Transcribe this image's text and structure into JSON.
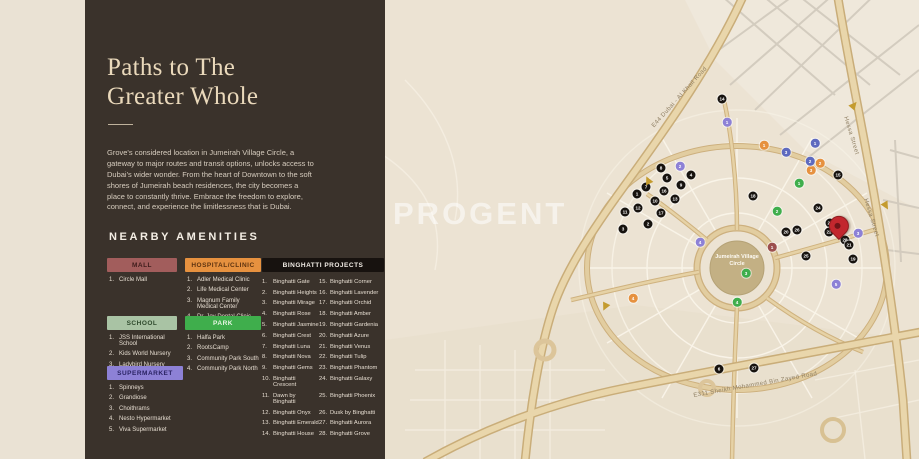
{
  "panel": {
    "title_line1": "Paths to The",
    "title_line2": "Greater Whole",
    "description": "Grove's considered location in Jumeirah Village Circle, a gateway to major routes and transit options, unlocks access to Dubai's wider wonder. From the heart of Downtown to the soft shores of Jumeirah beach residences, the city becomes a place to constantly thrive. Embrace the freedom to explore, connect, and experience the limitlessness that is Dubai.",
    "amenities_heading": "NEARBY AMENITIES",
    "categories": [
      {
        "id": "mall",
        "label": "MALL",
        "color": "#a25d5c",
        "text_color": "#3f1d1c",
        "items": [
          "Circle Mall"
        ]
      },
      {
        "id": "hospital",
        "label": "HOSPITAL/CLINIC",
        "color": "#e6913f",
        "text_color": "#5d3310",
        "items": [
          "Adler Medical Clinic",
          "Life Medical Center",
          "Magnum Family Medical Center",
          "Dr. Joy Dental Clinic"
        ]
      },
      {
        "id": "school",
        "label": "SCHOOL",
        "color": "#a9c3a4",
        "text_color": "#2f4a2d",
        "items": [
          "JSS International School",
          "Kids World Nursery",
          "Ladybird Nursery"
        ]
      },
      {
        "id": "park",
        "label": "PARK",
        "color": "#3fae4c",
        "text_color": "#e8f5e4",
        "items": [
          "Halfa Park",
          "RootsCamp",
          "Community Park South",
          "Community Park North"
        ]
      },
      {
        "id": "supermarket",
        "label": "SUPERMARKET",
        "color": "#8d81d6",
        "text_color": "#2a2363",
        "items": [
          "Spinneys",
          "Grandiose",
          "Choithrams",
          "Nesto Hypermarket",
          "Viva Supermarket"
        ]
      }
    ],
    "projects": {
      "label": "BINGHATTI PROJECTS",
      "color": "#17120f",
      "text_color": "#f2ede6",
      "items_left": [
        "Binghatti Gate",
        "Binghatti Heights",
        "Binghatti Mirage",
        "Binghatti Rose",
        "Binghatti Jasmine",
        "Binghatti Crest",
        "Binghatti Luna",
        "Binghatti Nova",
        "Binghatti Gems",
        "Binghatti Crescent",
        "Dawn by Binghatti",
        "Binghatti Onyx",
        "Binghatti Emerald",
        "Binghatti House"
      ],
      "items_right": [
        "Binghatti Corner",
        "Binghatti Lavender",
        "Binghatti Orchid",
        "Binghatti Amber",
        "Binghatti Gardenia",
        "Binghatti Azure",
        "Binghatti Venus",
        "Binghatti Tulip",
        "Binghatti Phantom",
        "Binghatti Galaxy",
        "Binghatti Phoenix",
        "Dusk by Binghatti",
        "Binghatti Aurora",
        "Binghatti Grove"
      ]
    }
  },
  "map": {
    "watermark": "PROGENT",
    "center_label": "Jumeirah Village Circle",
    "road_labels": [
      {
        "text": "E44 Dubai - Al Khail Road"
      },
      {
        "text": "Hessa Street"
      },
      {
        "text": "Hessa Street"
      },
      {
        "text": "E311 Sheikh Mohammed Bin Zayed Road"
      }
    ],
    "marker_colors": {
      "project": "#17130f"
    },
    "markers": {
      "projects": [
        {
          "n": 14,
          "x": 722,
          "y": 99
        },
        {
          "n": 8,
          "x": 661,
          "y": 168
        },
        {
          "n": 5,
          "x": 667,
          "y": 178
        },
        {
          "n": 4,
          "x": 691,
          "y": 175
        },
        {
          "n": 9,
          "x": 681,
          "y": 185
        },
        {
          "n": 7,
          "x": 646,
          "y": 187
        },
        {
          "n": 1,
          "x": 637,
          "y": 194
        },
        {
          "n": 16,
          "x": 664,
          "y": 191
        },
        {
          "n": 13,
          "x": 675,
          "y": 199
        },
        {
          "n": 10,
          "x": 655,
          "y": 201
        },
        {
          "n": 12,
          "x": 638,
          "y": 208
        },
        {
          "n": 17,
          "x": 661,
          "y": 213
        },
        {
          "n": 11,
          "x": 625,
          "y": 212
        },
        {
          "n": 2,
          "x": 648,
          "y": 224
        },
        {
          "n": 3,
          "x": 623,
          "y": 229
        },
        {
          "n": 18,
          "x": 753,
          "y": 196
        },
        {
          "n": 15,
          "x": 838,
          "y": 175
        },
        {
          "n": 24,
          "x": 818,
          "y": 208
        },
        {
          "n": 23,
          "x": 830,
          "y": 223
        },
        {
          "n": 22,
          "x": 829,
          "y": 232
        },
        {
          "n": 26,
          "x": 797,
          "y": 230
        },
        {
          "n": 20,
          "x": 786,
          "y": 232
        },
        {
          "n": 28,
          "x": 845,
          "y": 240
        },
        {
          "n": 21,
          "x": 849,
          "y": 245
        },
        {
          "n": 19,
          "x": 853,
          "y": 259
        },
        {
          "n": 25,
          "x": 806,
          "y": 256
        },
        {
          "n": 6,
          "x": 719,
          "y": 369
        },
        {
          "n": 27,
          "x": 754,
          "y": 368
        }
      ],
      "amenities": {
        "mall": {
          "color": "#9c4f4e",
          "points": [
            {
              "n": 1,
              "x": 772,
              "y": 247
            }
          ]
        },
        "hospital": {
          "color": "#e6913f",
          "points": [
            {
              "n": 1,
              "x": 764,
              "y": 145
            },
            {
              "n": 2,
              "x": 820,
              "y": 163
            },
            {
              "n": 3,
              "x": 811,
              "y": 170
            },
            {
              "n": 4,
              "x": 633,
              "y": 298
            }
          ]
        },
        "school": {
          "color": "#5e6abf",
          "points": [
            {
              "n": 1,
              "x": 815,
              "y": 143
            },
            {
              "n": 2,
              "x": 810,
              "y": 161
            },
            {
              "n": 3,
              "x": 786,
              "y": 152
            }
          ]
        },
        "park": {
          "color": "#3fae4c",
          "points": [
            {
              "n": 1,
              "x": 799,
              "y": 183
            },
            {
              "n": 2,
              "x": 777,
              "y": 211
            },
            {
              "n": 3,
              "x": 746,
              "y": 273
            },
            {
              "n": 4,
              "x": 737,
              "y": 302
            }
          ]
        },
        "supermarket": {
          "color": "#8d81d6",
          "points": [
            {
              "n": 1,
              "x": 727,
              "y": 122
            },
            {
              "n": 2,
              "x": 680,
              "y": 166
            },
            {
              "n": 3,
              "x": 858,
              "y": 233
            },
            {
              "n": 4,
              "x": 700,
              "y": 242
            },
            {
              "n": 5,
              "x": 836,
              "y": 284
            }
          ]
        }
      },
      "arrows": [
        {
          "x": 854,
          "y": 105
        },
        {
          "x": 886,
          "y": 206
        },
        {
          "x": 648,
          "y": 180
        },
        {
          "x": 605,
          "y": 307
        }
      ],
      "pin": {
        "x": 846,
        "y": 233
      }
    }
  }
}
